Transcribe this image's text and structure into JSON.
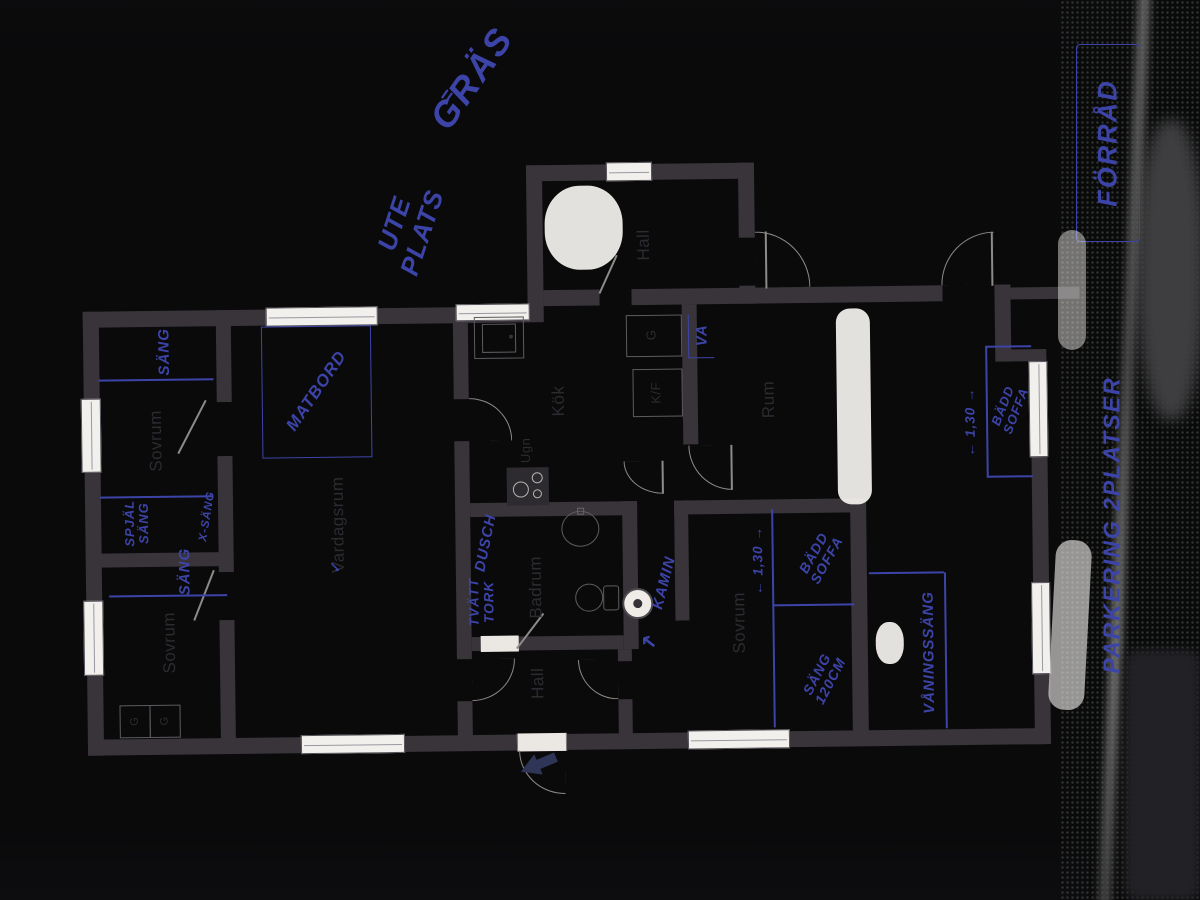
{
  "colors": {
    "paper": "#e7e4e0",
    "background": "#0a0a0b",
    "wall": "#38343a",
    "pen_blue": "#3d44a8",
    "entrance_arrow_navy": "#2e3557"
  },
  "printed_labels": {
    "hall_top": "Hall",
    "sovrum_top_left": "Sovrum",
    "sovrum_bottom_left": "Sovrum",
    "sovrum_right": "Sovrum",
    "vardagsrum": "Vardagsrum",
    "kok": "Kök",
    "ugn": "Ugn",
    "closet_kitchen": "G",
    "kf": "K/F",
    "rum": "Rum",
    "badrum": "Badrum",
    "hall_bottom": "Hall",
    "closet_1": "G",
    "closet_2": "G"
  },
  "handwritten": {
    "gras": "GRÄS",
    "gras_mark": "=",
    "ute": "UTE",
    "plats": "PLATS",
    "forrad": "FÖRRÅD",
    "parkering": "PARKERING 2PLATSER",
    "sang_top": "SÄNG",
    "spjal_line1": "SPJÄL",
    "spjal_line2": "SÄNG",
    "x_sang": "X-SÄNG",
    "sang_left": "SÄNG",
    "matbord": "MATBORD",
    "va": "VA",
    "dusch": "DUSCH",
    "tvatt": "TVÄTT",
    "tork": "TORK",
    "kamin": "KAMIN",
    "kamin_arrow": "↖",
    "check": "✓",
    "dim_sovrum": "← 1,30 →",
    "badd_sovrum_l1": "BÄDD",
    "badd_sovrum_l2": "SOFFA",
    "sang120_l1": "SÄNG",
    "sang120_l2": "120CM",
    "dim_rum": "← 1,30 →",
    "badd_rum_l1": "BÄDD",
    "badd_rum_l2": "SOFFA",
    "vaningssang": "VÅNINGSSÄNG"
  }
}
